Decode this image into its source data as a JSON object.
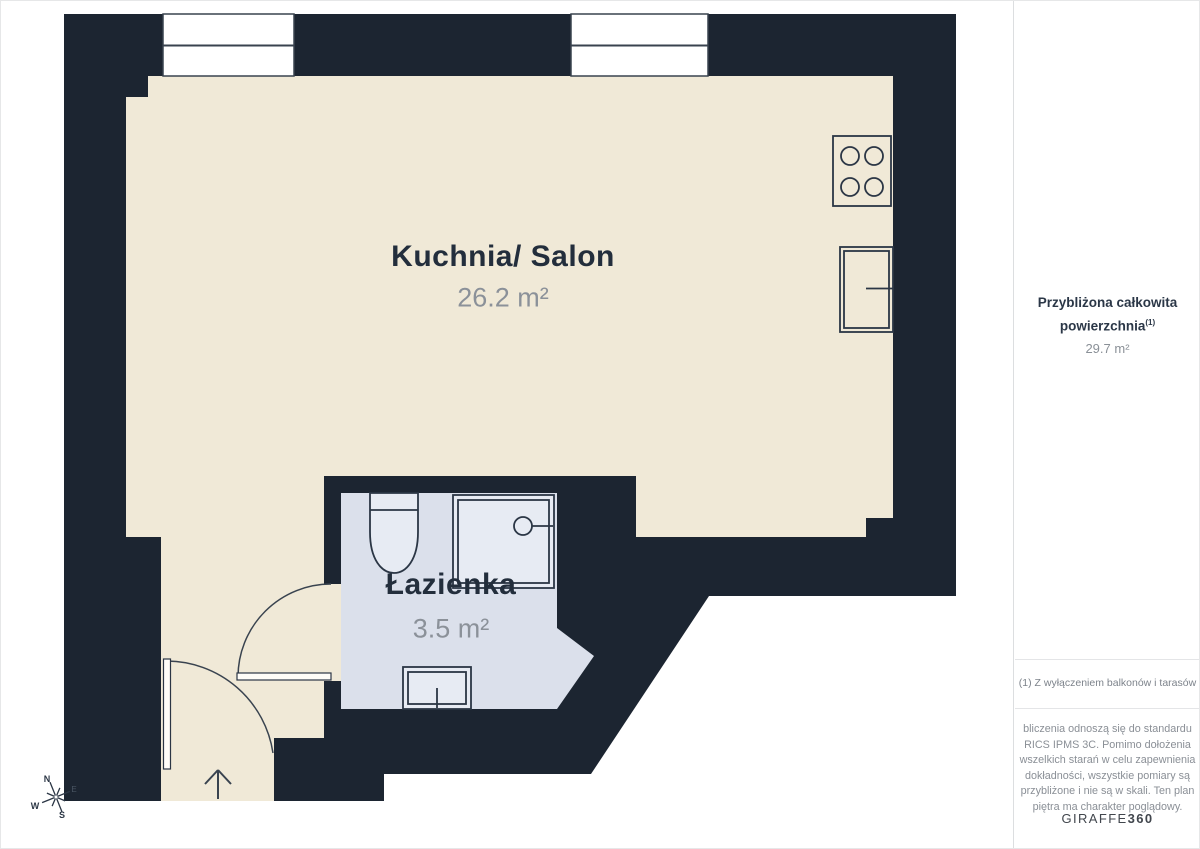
{
  "colors": {
    "wall": "#1c2531",
    "floor": "#f0e9d7",
    "bathroom": "#dbe0eb",
    "fixture_fill": "#e7ebf3",
    "line": "#2b3645"
  },
  "rooms": [
    {
      "name": "Kuchnia/ Salon",
      "area": "26.2 m²"
    },
    {
      "name": "Łazienka",
      "area": "3.5 m²"
    }
  ],
  "sidebar": {
    "title": "Przybliżona całkowita powierzchnia",
    "title_sup": "(1)",
    "total_area": "29.7 m²",
    "note": "(1) Z wyłączeniem balkonów i tarasów",
    "disclaimer": "bliczenia odnoszą się do standardu RICS IPMS 3C. Pomimo dołożenia wszelkich starań w celu zapewnienia dokładności, wszystkie pomiary są przybliżone i nie są w skali. Ten plan piętra ma charakter poglądowy.",
    "brand": {
      "name": "GIRAFFE",
      "suffix": "360"
    }
  },
  "compass": {
    "n": "N",
    "e": "E",
    "s": "S",
    "w": "W"
  }
}
